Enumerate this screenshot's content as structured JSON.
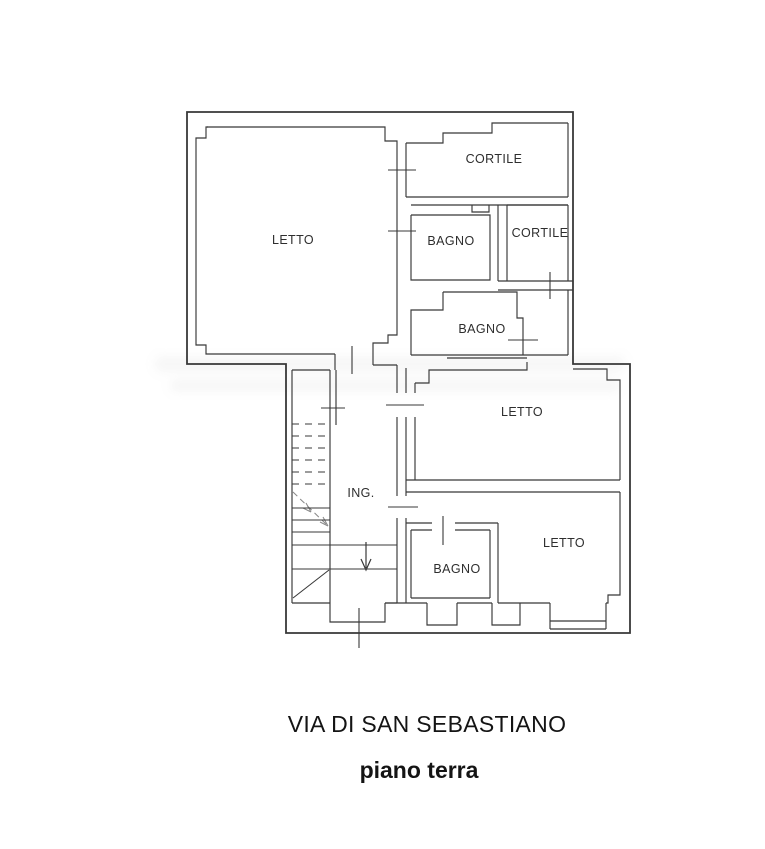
{
  "colors": {
    "ink": "#383838",
    "label": "#2e2e2e",
    "title": "#141414",
    "background": "#ffffff"
  },
  "rooms": [
    {
      "id": "letto-main",
      "label": "LETTO"
    },
    {
      "id": "cortile-top",
      "label": "CORTILE"
    },
    {
      "id": "bagno-top",
      "label": "BAGNO"
    },
    {
      "id": "cortile-right",
      "label": "CORTILE"
    },
    {
      "id": "bagno-mid",
      "label": "BAGNO"
    },
    {
      "id": "letto-top-right",
      "label": "LETTO"
    },
    {
      "id": "ingresso",
      "label": "ING."
    },
    {
      "id": "bagno-bottom",
      "label": "BAGNO"
    },
    {
      "id": "letto-bottom-right",
      "label": "LETTO"
    }
  ],
  "footer": {
    "title": "VIA DI SAN SEBASTIANO",
    "subtitle": "piano terra"
  }
}
